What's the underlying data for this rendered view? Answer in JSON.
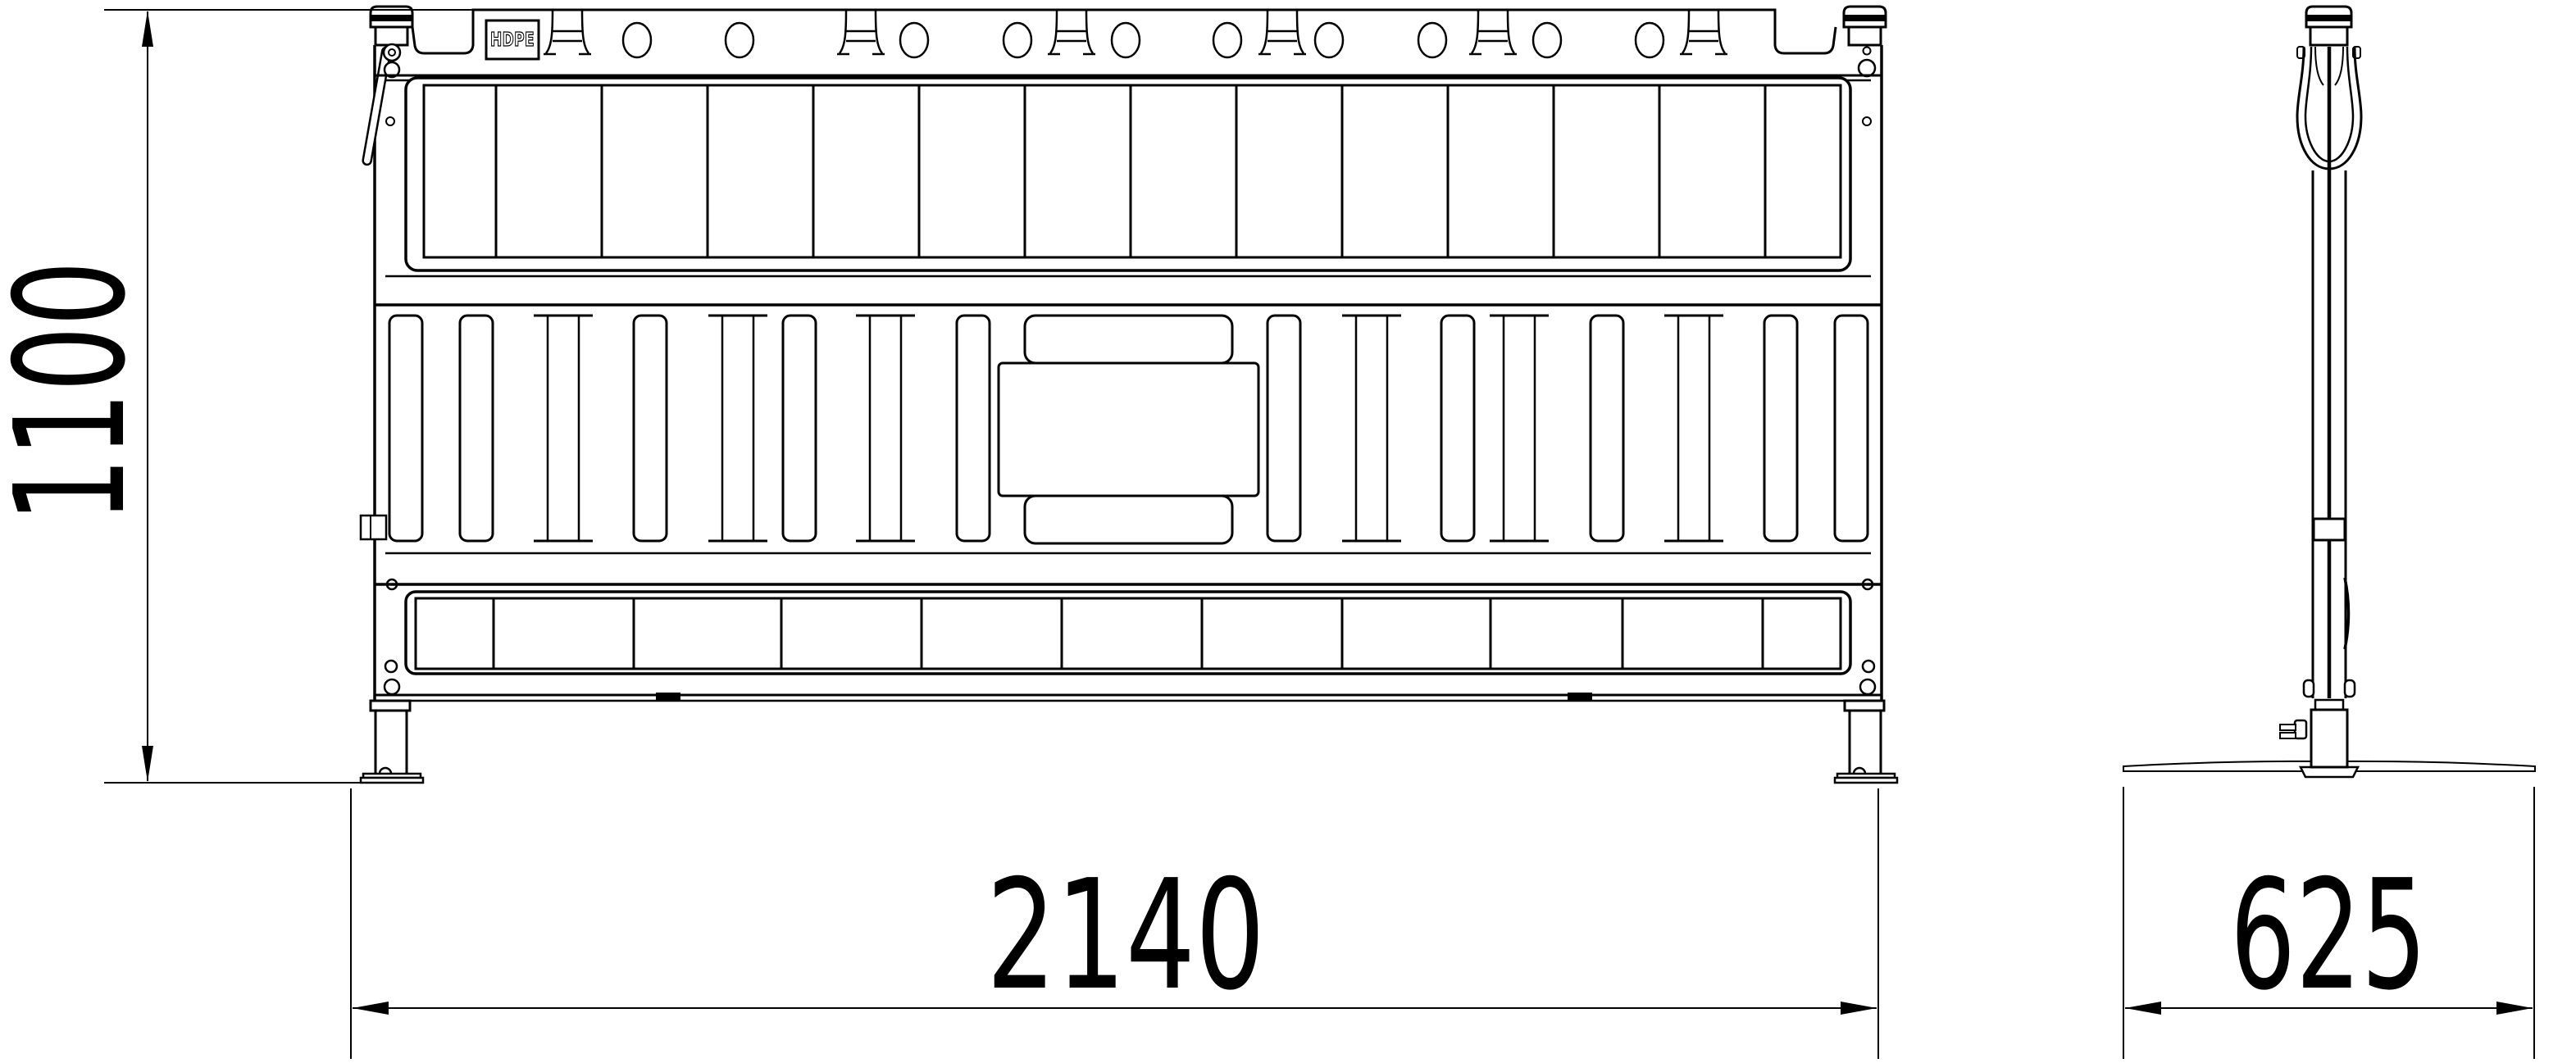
{
  "page": {
    "background_color": "#ffffff",
    "line_color": "#000000",
    "content_type": "technical drawing, barrier fence panel, front and side elevation"
  },
  "drawing": {
    "material_label": "HDPE",
    "dimensions": {
      "height": {
        "value": "1100",
        "orientation": "vertical"
      },
      "width": {
        "value": "2140",
        "orientation": "horizontal"
      },
      "depth": {
        "value": "625",
        "orientation": "horizontal"
      }
    }
  }
}
